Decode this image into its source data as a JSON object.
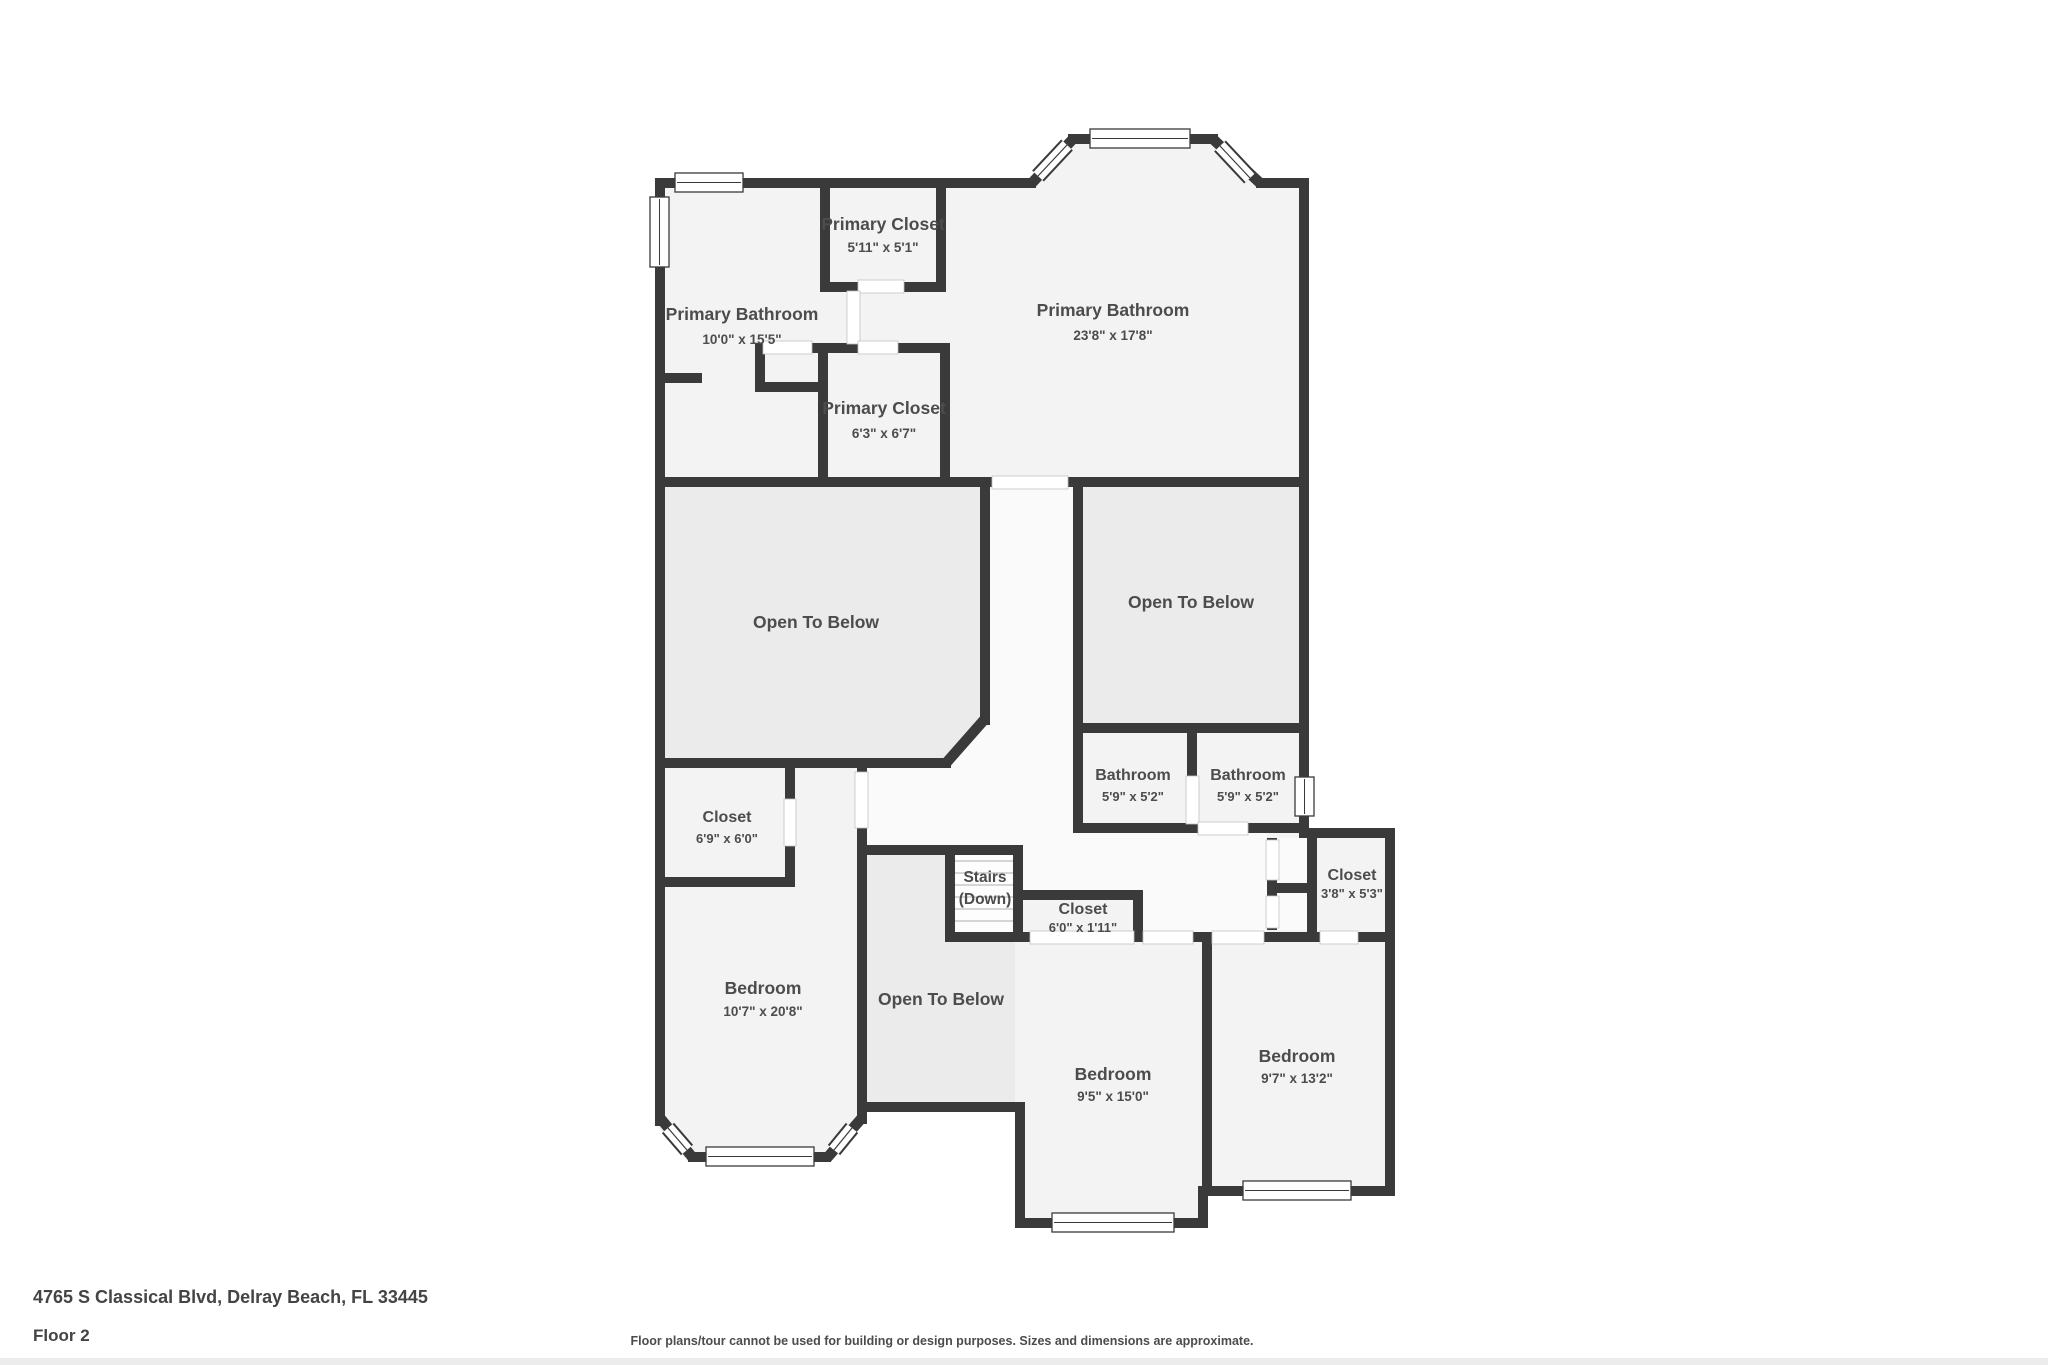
{
  "plan": {
    "rooms": {
      "primary_closet_a": {
        "name": "Primary Closet",
        "dims": "5'11\" x 5'1\""
      },
      "primary_bathroom_a": {
        "name": "Primary Bathroom",
        "dims": "10'0\" x 15'5\""
      },
      "primary_bathroom_b": {
        "name": "Primary Bathroom",
        "dims": "23'8\" x 17'8\""
      },
      "primary_closet_b": {
        "name": "Primary Closet",
        "dims": "6'3\" x 6'7\""
      },
      "open_below_left": {
        "name": "Open To Below"
      },
      "open_below_right": {
        "name": "Open To Below"
      },
      "open_below_middle": {
        "name": "Open To Below"
      },
      "bathroom_a": {
        "name": "Bathroom",
        "dims": "5'9\" x 5'2\""
      },
      "bathroom_b": {
        "name": "Bathroom",
        "dims": "5'9\" x 5'2\""
      },
      "closet_a": {
        "name": "Closet",
        "dims": "6'9\" x 6'0\""
      },
      "stairs": {
        "name": "Stairs",
        "dims": "(Down)"
      },
      "closet_b": {
        "name": "Closet",
        "dims": "6'0\" x 1'11\""
      },
      "closet_c": {
        "name": "Closet",
        "dims": "3'8\" x 5'3\""
      },
      "bedroom_a": {
        "name": "Bedroom",
        "dims": "10'7\" x 20'8\""
      },
      "bedroom_b": {
        "name": "Bedroom",
        "dims": "9'5\" x 15'0\""
      },
      "bedroom_c": {
        "name": "Bedroom",
        "dims": "9'7\" x 13'2\""
      }
    },
    "colors": {
      "wall": "#3a3a3a",
      "room_fill": "#f3f3f3",
      "open_to_below_fill": "#ebebeb",
      "hall_fill": "#fafafa",
      "label_text": "#4c4c4c"
    }
  },
  "footer": {
    "address": "4765 S Classical Blvd, Delray Beach, FL 33445",
    "floor_label": "Floor 2",
    "disclaimer": "Floor plans/tour cannot be used for building or design purposes. Sizes and dimensions are approximate."
  }
}
